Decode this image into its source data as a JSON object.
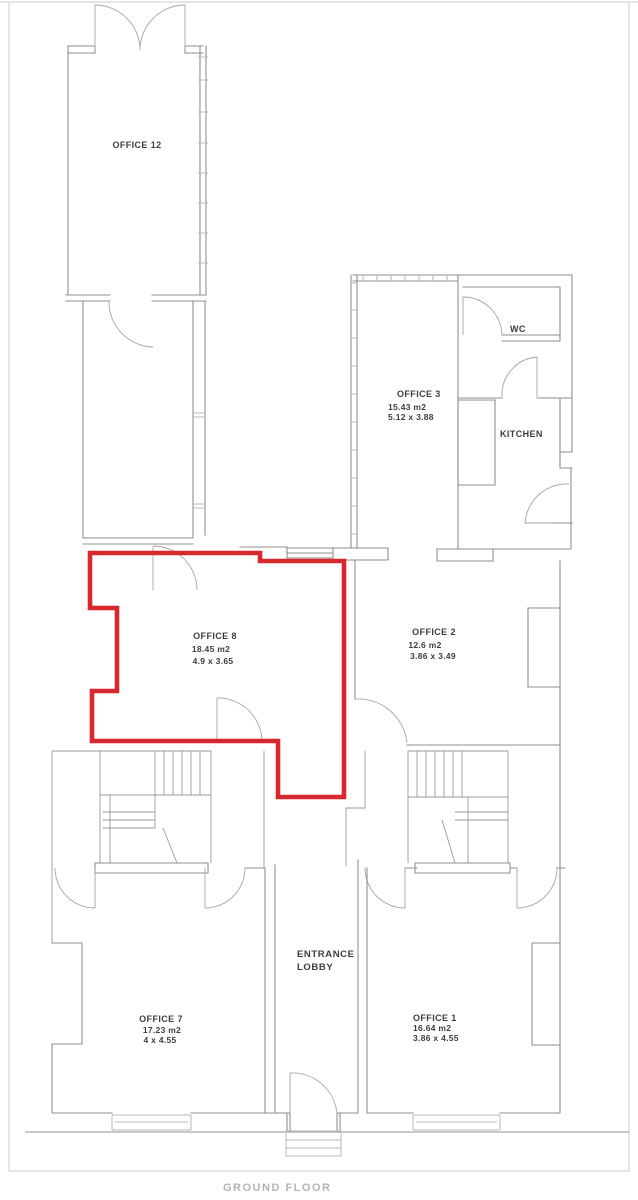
{
  "floor": {
    "title": "GROUND FLOOR"
  },
  "highlight": {
    "color": "#d7282d",
    "highlighted_room": "OFFICE 8"
  },
  "rooms": {
    "office12": {
      "name": "OFFICE 12"
    },
    "office3": {
      "name": "OFFICE 3",
      "area": "15.43 m2",
      "dims": "5.12 x 3.88"
    },
    "wc": {
      "name": "WC"
    },
    "kitchen": {
      "name": "KITCHEN"
    },
    "office8": {
      "name": "OFFICE 8",
      "area": "18.45 m2",
      "dims": "4.9 x 3.65"
    },
    "office2": {
      "name": "OFFICE 2",
      "area": "12.6 m2",
      "dims": "3.86 x 3.49"
    },
    "office7": {
      "name": "OFFICE 7",
      "area": "17.23 m2",
      "dims": "4 x 4.55"
    },
    "office1": {
      "name": "OFFICE 1",
      "area": "16.64 m2",
      "dims": "3.86 x 4.55"
    },
    "entrance_lobby": {
      "line1": "ENTRANCE",
      "line2": "LOBBY"
    }
  }
}
